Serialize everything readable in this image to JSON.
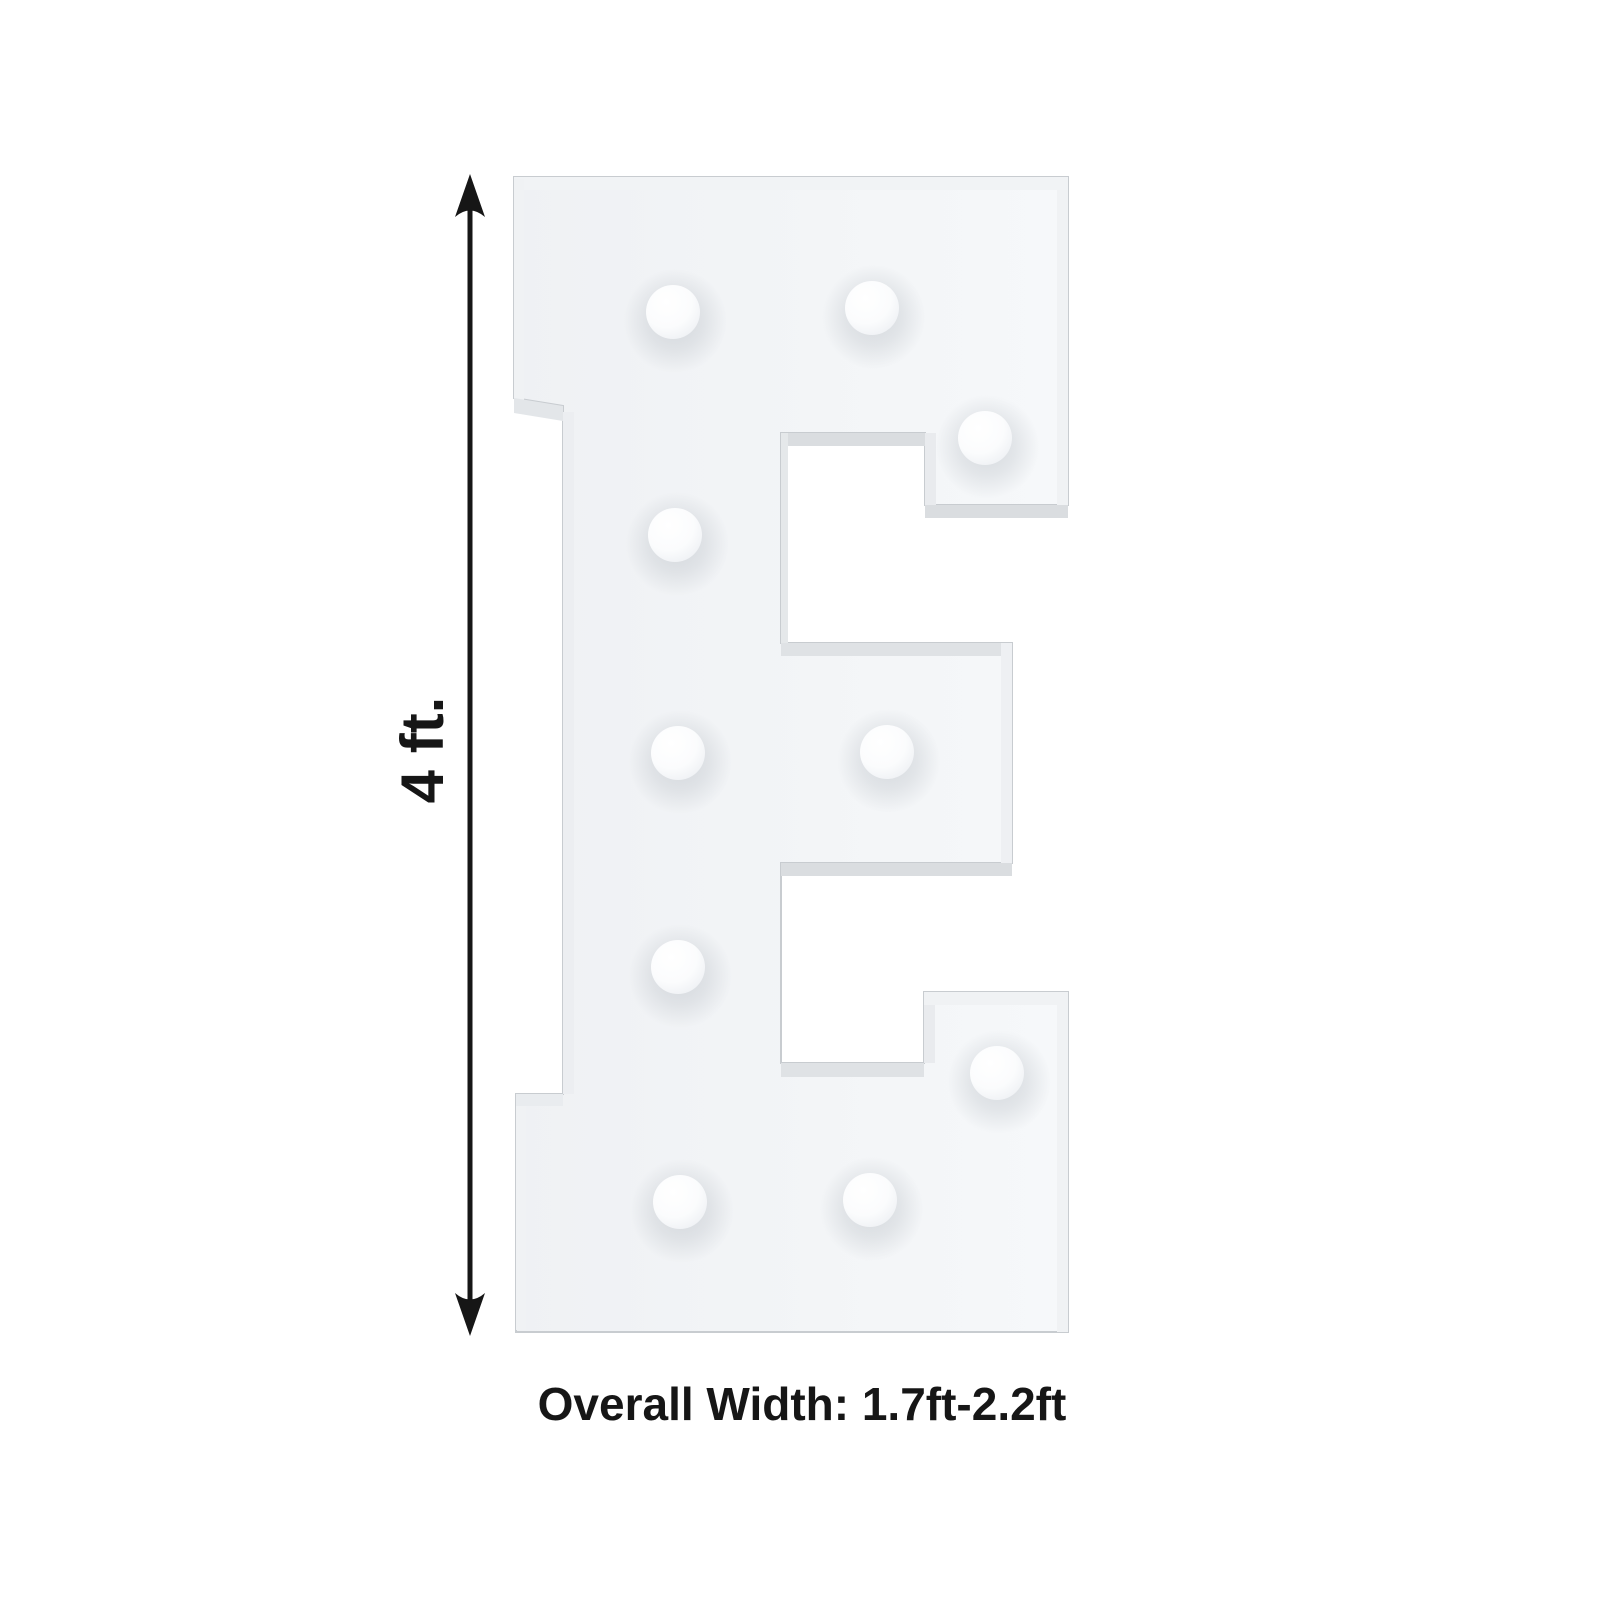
{
  "page": {
    "background": "#ffffff"
  },
  "annotations": {
    "height_label": "4 ft.",
    "width_label": "Overall Width: 1.7ft-2.2ft"
  },
  "figure": {
    "letter": "E",
    "bulb_count": 10,
    "colors": {
      "background": "#ffffff",
      "letter_face_light": "#f6f8fa",
      "letter_face_dark": "#eff1f4",
      "letter_edge": "#c8ccd0",
      "bevel_shade": "#dadde0",
      "bevel_light": "#f1f3f5",
      "bulb": "#fdfdff",
      "bulb_shadow": "#b4bac1",
      "annotation": "#161616"
    },
    "outline": [
      [
        514,
        177
      ],
      [
        1068,
        177
      ],
      [
        1068,
        505
      ],
      [
        925,
        505
      ],
      [
        925,
        433
      ],
      [
        781,
        433
      ],
      [
        781,
        643
      ],
      [
        1012,
        643
      ],
      [
        1012,
        863
      ],
      [
        781,
        863
      ],
      [
        781,
        1063
      ],
      [
        924,
        1063
      ],
      [
        924,
        992
      ],
      [
        1068,
        992
      ],
      [
        1068,
        1332
      ],
      [
        516,
        1332
      ],
      [
        516,
        1094
      ],
      [
        563,
        1094
      ],
      [
        563,
        406
      ],
      [
        514,
        398
      ]
    ],
    "bulbs": [
      [
        673,
        312
      ],
      [
        872,
        308
      ],
      [
        985,
        438
      ],
      [
        675,
        535
      ],
      [
        678,
        753
      ],
      [
        887,
        752
      ],
      [
        678,
        967
      ],
      [
        997,
        1073
      ],
      [
        680,
        1202
      ],
      [
        870,
        1200
      ]
    ],
    "bulb_radius": 27,
    "arrow": {
      "x": 470,
      "y1": 174,
      "y2": 1336
    }
  }
}
